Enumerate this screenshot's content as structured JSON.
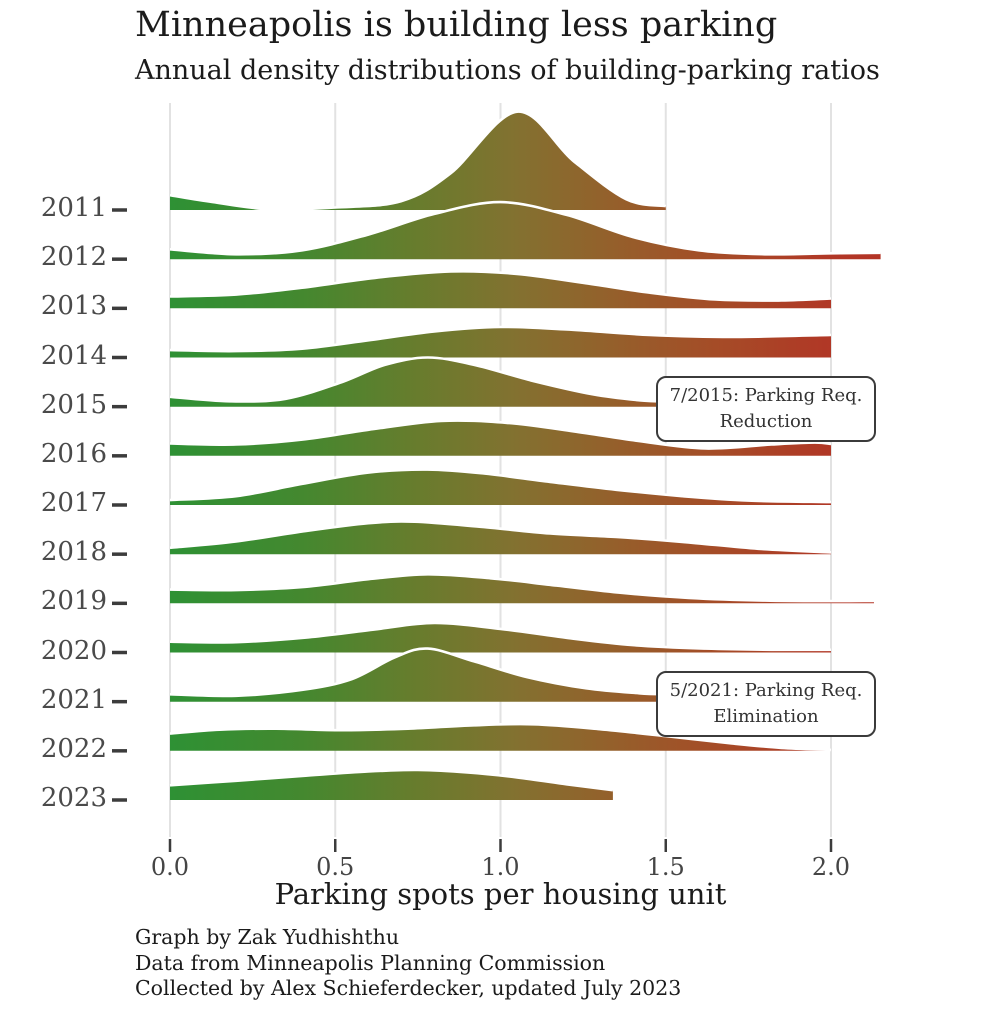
{
  "title": "Minneapolis is building less parking",
  "subtitle": "Annual density distributions of building-parking ratios",
  "x_axis": {
    "label": "Parking spots per housing unit",
    "tick_labels": [
      "0.0",
      "0.5",
      "1.0",
      "1.5",
      "2.0"
    ],
    "tick_values": [
      0,
      0.5,
      1.0,
      1.5,
      2.0
    ]
  },
  "annotations": [
    {
      "line1": "7/2015: Parking Req.",
      "line2": "Reduction",
      "x": 1.47,
      "year": 2015
    },
    {
      "line1": "5/2021: Parking Req.",
      "line2": "Elimination",
      "x": 1.47,
      "year": 2021
    }
  ],
  "footer": {
    "lines": [
      "Graph by Zak Yudhishthu",
      "Data from Minneapolis Planning Commission",
      "Collected by Alex Schieferdecker, updated July 2023"
    ]
  },
  "colors": {
    "background": "#ffffff",
    "gridline": "#e2e2e2",
    "axis_tick": "#3c3c3c",
    "ridge_outline": "#ffffff",
    "gradient_green": "#2e9134",
    "gradient_olive": "#837130",
    "gradient_red": "#b23726",
    "text": "#1b1b1b",
    "label_gray": "#4a4a4a"
  },
  "chart_data": {
    "type": "area",
    "variant": "ridgeline",
    "title": "Minneapolis is building less parking",
    "subtitle": "Annual density distributions of building-parking ratios",
    "xlabel": "Parking spots per housing unit",
    "x_range": [
      0,
      2.2
    ],
    "grid": "vertical-only",
    "categories": [
      "2011",
      "2012",
      "2013",
      "2014",
      "2015",
      "2016",
      "2017",
      "2018",
      "2019",
      "2020",
      "2021",
      "2022",
      "2023"
    ],
    "height_units": "density in row-height units (1.0 = vertical spacing between consecutive year baselines)",
    "gradient_stops": [
      {
        "x": 0.0,
        "color": "#2e9134"
      },
      {
        "x": 0.4,
        "color": "#44882f"
      },
      {
        "x": 0.75,
        "color": "#687c2d"
      },
      {
        "x": 1.05,
        "color": "#837130"
      },
      {
        "x": 1.35,
        "color": "#955f2b"
      },
      {
        "x": 1.65,
        "color": "#a54c27"
      },
      {
        "x": 2.0,
        "color": "#b13726"
      },
      {
        "x": 2.2,
        "color": "#b43325"
      }
    ],
    "series": [
      {
        "year": "2011",
        "points": [
          [
            0,
            0.3
          ],
          [
            0.12,
            0.17
          ],
          [
            0.3,
            0.015
          ],
          [
            0.5,
            0.05
          ],
          [
            0.7,
            0.18
          ],
          [
            0.85,
            0.75
          ],
          [
            1.05,
            2.0
          ],
          [
            1.22,
            1.0
          ],
          [
            1.38,
            0.22
          ],
          [
            1.5,
            0.08
          ]
        ]
      },
      {
        "year": "2012",
        "points": [
          [
            0,
            0.2
          ],
          [
            0.2,
            0.1
          ],
          [
            0.4,
            0.18
          ],
          [
            0.6,
            0.5
          ],
          [
            0.8,
            0.92
          ],
          [
            1.0,
            1.16
          ],
          [
            1.2,
            0.9
          ],
          [
            1.4,
            0.45
          ],
          [
            1.6,
            0.18
          ],
          [
            1.8,
            0.1
          ],
          [
            2.0,
            0.12
          ],
          [
            2.15,
            0.13
          ]
        ]
      },
      {
        "year": "2013",
        "points": [
          [
            0,
            0.24
          ],
          [
            0.2,
            0.28
          ],
          [
            0.4,
            0.42
          ],
          [
            0.62,
            0.62
          ],
          [
            0.85,
            0.75
          ],
          [
            1.05,
            0.7
          ],
          [
            1.25,
            0.52
          ],
          [
            1.45,
            0.32
          ],
          [
            1.65,
            0.18
          ],
          [
            1.85,
            0.16
          ],
          [
            2.0,
            0.2
          ]
        ]
      },
      {
        "year": "2014",
        "points": [
          [
            0,
            0.15
          ],
          [
            0.2,
            0.13
          ],
          [
            0.4,
            0.18
          ],
          [
            0.6,
            0.35
          ],
          [
            0.8,
            0.53
          ],
          [
            1.0,
            0.62
          ],
          [
            1.2,
            0.57
          ],
          [
            1.45,
            0.46
          ],
          [
            1.7,
            0.42
          ],
          [
            2.0,
            0.46
          ]
        ]
      },
      {
        "year": "2015",
        "points": [
          [
            0,
            0.2
          ],
          [
            0.18,
            0.11
          ],
          [
            0.35,
            0.16
          ],
          [
            0.52,
            0.5
          ],
          [
            0.65,
            0.85
          ],
          [
            0.78,
            1.0
          ],
          [
            0.92,
            0.85
          ],
          [
            1.1,
            0.52
          ],
          [
            1.28,
            0.25
          ],
          [
            1.42,
            0.13
          ],
          [
            1.52,
            0.1
          ]
        ]
      },
      {
        "year": "2016",
        "points": [
          [
            0,
            0.25
          ],
          [
            0.2,
            0.23
          ],
          [
            0.4,
            0.33
          ],
          [
            0.6,
            0.53
          ],
          [
            0.82,
            0.71
          ],
          [
            1.02,
            0.67
          ],
          [
            1.22,
            0.5
          ],
          [
            1.42,
            0.3
          ],
          [
            1.62,
            0.15
          ],
          [
            1.82,
            0.23
          ],
          [
            1.95,
            0.27
          ],
          [
            2.0,
            0.24
          ]
        ]
      },
      {
        "year": "2017",
        "points": [
          [
            0,
            0.1
          ],
          [
            0.2,
            0.18
          ],
          [
            0.4,
            0.43
          ],
          [
            0.6,
            0.66
          ],
          [
            0.78,
            0.72
          ],
          [
            0.95,
            0.64
          ],
          [
            1.15,
            0.47
          ],
          [
            1.35,
            0.31
          ],
          [
            1.55,
            0.18
          ],
          [
            1.75,
            0.09
          ],
          [
            2.0,
            0.06
          ]
        ]
      },
      {
        "year": "2018",
        "points": [
          [
            0,
            0.13
          ],
          [
            0.2,
            0.26
          ],
          [
            0.42,
            0.48
          ],
          [
            0.6,
            0.63
          ],
          [
            0.74,
            0.66
          ],
          [
            0.95,
            0.55
          ],
          [
            1.15,
            0.42
          ],
          [
            1.35,
            0.35
          ],
          [
            1.55,
            0.25
          ],
          [
            1.78,
            0.11
          ],
          [
            2.0,
            0.035
          ]
        ]
      },
      {
        "year": "2019",
        "points": [
          [
            0,
            0.28
          ],
          [
            0.2,
            0.27
          ],
          [
            0.4,
            0.33
          ],
          [
            0.6,
            0.49
          ],
          [
            0.78,
            0.59
          ],
          [
            0.97,
            0.51
          ],
          [
            1.17,
            0.36
          ],
          [
            1.37,
            0.21
          ],
          [
            1.57,
            0.11
          ],
          [
            1.8,
            0.055
          ],
          [
            2.0,
            0.045
          ],
          [
            2.13,
            0.05
          ]
        ]
      },
      {
        "year": "2020",
        "points": [
          [
            0,
            0.22
          ],
          [
            0.2,
            0.21
          ],
          [
            0.42,
            0.31
          ],
          [
            0.62,
            0.47
          ],
          [
            0.8,
            0.6
          ],
          [
            1.0,
            0.48
          ],
          [
            1.2,
            0.3
          ],
          [
            1.4,
            0.15
          ],
          [
            1.62,
            0.08
          ],
          [
            1.82,
            0.055
          ],
          [
            2.0,
            0.055
          ]
        ]
      },
      {
        "year": "2021",
        "points": [
          [
            0,
            0.15
          ],
          [
            0.2,
            0.12
          ],
          [
            0.4,
            0.24
          ],
          [
            0.55,
            0.46
          ],
          [
            0.68,
            0.9
          ],
          [
            0.78,
            1.08
          ],
          [
            0.92,
            0.82
          ],
          [
            1.08,
            0.5
          ],
          [
            1.26,
            0.27
          ],
          [
            1.42,
            0.17
          ],
          [
            1.5,
            0.15
          ]
        ]
      },
      {
        "year": "2022",
        "points": [
          [
            0,
            0.35
          ],
          [
            0.15,
            0.43
          ],
          [
            0.32,
            0.45
          ],
          [
            0.52,
            0.42
          ],
          [
            0.72,
            0.45
          ],
          [
            0.92,
            0.52
          ],
          [
            1.1,
            0.54
          ],
          [
            1.3,
            0.44
          ],
          [
            1.5,
            0.3
          ],
          [
            1.7,
            0.15
          ],
          [
            1.85,
            0.06
          ],
          [
            2.0,
            0.02
          ]
        ]
      },
      {
        "year": "2023",
        "points": [
          [
            0,
            0.3
          ],
          [
            0.2,
            0.39
          ],
          [
            0.4,
            0.49
          ],
          [
            0.6,
            0.58
          ],
          [
            0.75,
            0.61
          ],
          [
            0.9,
            0.56
          ],
          [
            1.05,
            0.46
          ],
          [
            1.2,
            0.32
          ],
          [
            1.34,
            0.2
          ]
        ]
      }
    ]
  }
}
